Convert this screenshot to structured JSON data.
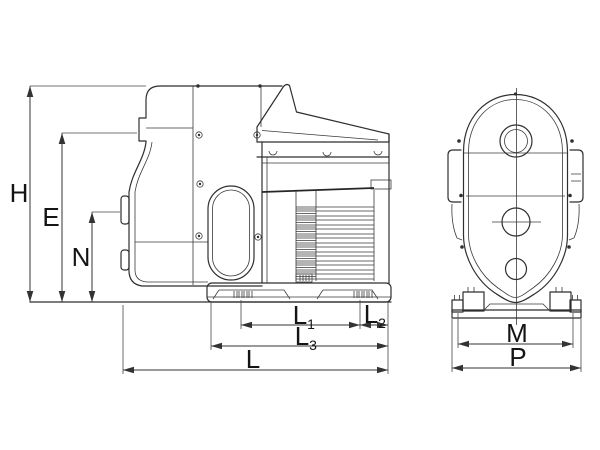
{
  "page": {
    "background": "#ffffff"
  },
  "drawing": {
    "kind": "pump-dimension-drawing",
    "line_color": "#2f2f2f",
    "dimension_color": "#333333",
    "text_color": "#141414"
  },
  "dimensions": {
    "H": {
      "label": "H"
    },
    "E": {
      "label": "E"
    },
    "N": {
      "label": "N"
    },
    "L1": {
      "label": "L",
      "sub": "1"
    },
    "L2": {
      "label": "L",
      "sub": "2"
    },
    "L3": {
      "label": "L",
      "sub": "3"
    },
    "L": {
      "label": "L"
    },
    "M": {
      "label": "M"
    },
    "P": {
      "label": "P"
    }
  }
}
